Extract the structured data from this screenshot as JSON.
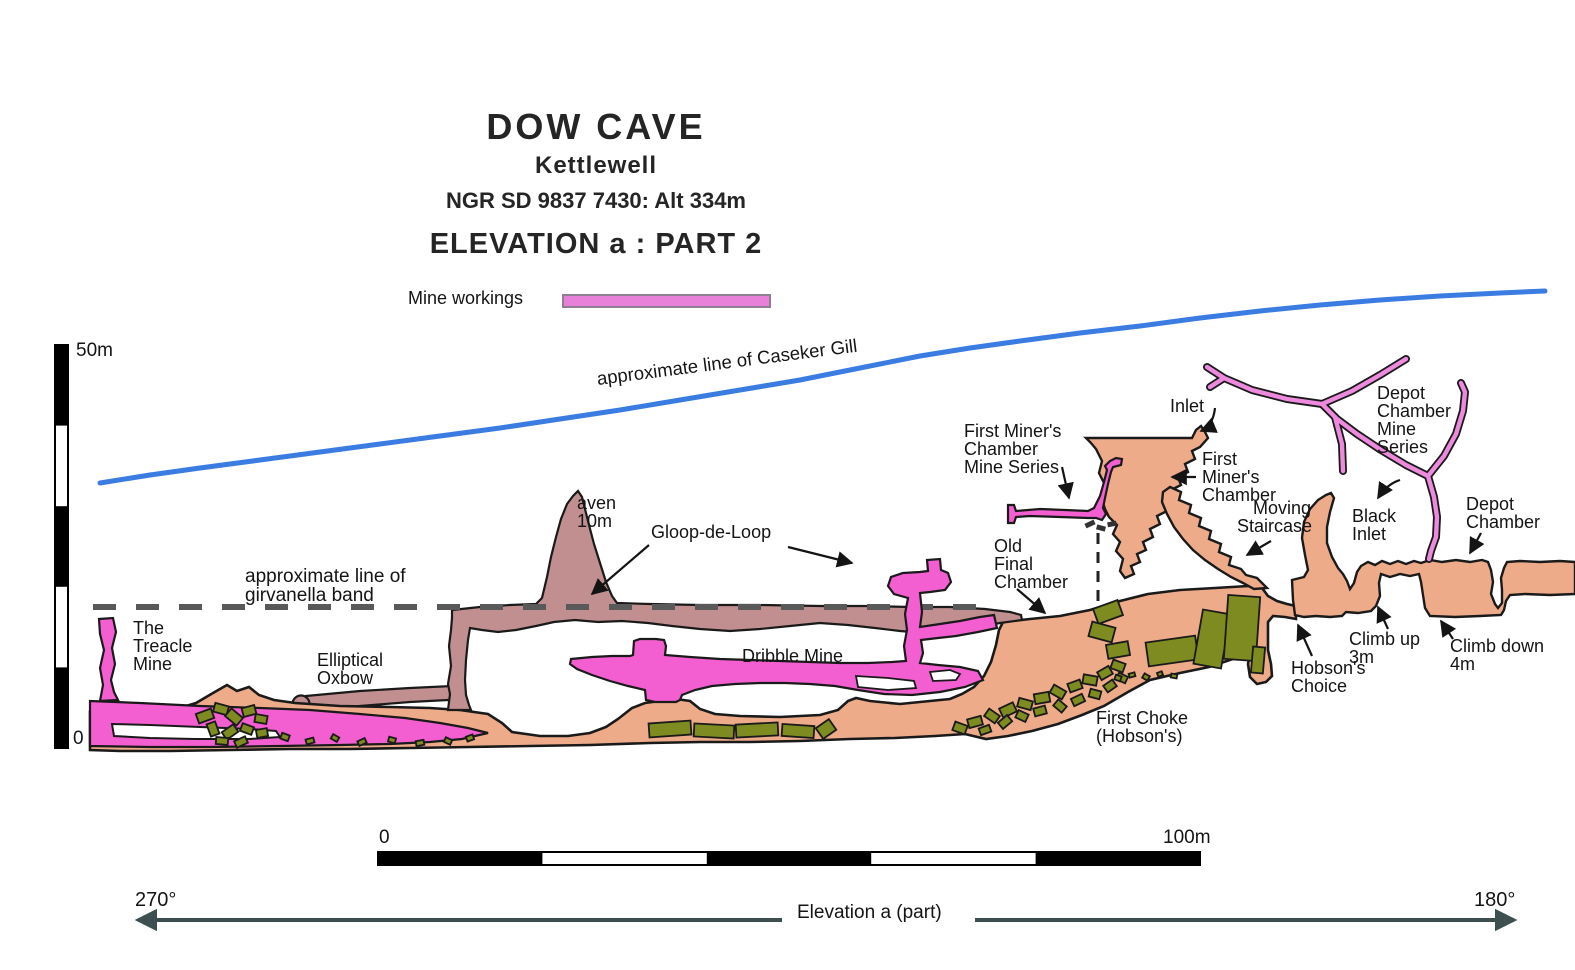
{
  "title_block": {
    "title": "DOW CAVE",
    "subtitle": "Kettlewell",
    "ngr": "NGR SD 9837 7430: Alt 334m",
    "heading": "ELEVATION a : PART 2"
  },
  "legend": {
    "mine_workings": "Mine workings"
  },
  "scale_vertical": {
    "top": "50m",
    "bottom": "0"
  },
  "scale_horizontal": {
    "left": "0",
    "right": "100m"
  },
  "surface_line": {
    "label": "approximate line of Caseker Gill"
  },
  "girvanella": {
    "line1": "approximate line of",
    "line2": "girvanella band"
  },
  "map_labels": {
    "aven": {
      "line1": "aven",
      "line2": "10m"
    },
    "gloop": "Gloop-de-Loop",
    "treacle": {
      "line1": "The",
      "line2": "Treacle",
      "line3": "Mine"
    },
    "oxbow": {
      "line1": "Elliptical",
      "line2": "Oxbow"
    },
    "dribble": "Dribble Mine",
    "old_final": {
      "line1": "Old",
      "line2": "Final",
      "line3": "Chamber"
    },
    "fmc_series": {
      "line1": "First Miner's",
      "line2": "Chamber",
      "line3": "Mine Series"
    },
    "inlet": "Inlet",
    "fmc": {
      "line1": "First",
      "line2": "Miner's",
      "line3": "Chamber"
    },
    "moving": {
      "line1": "Moving",
      "line2": "Staircase"
    },
    "black_inlet": {
      "line1": "Black",
      "line2": "Inlet"
    },
    "depot_series": {
      "line1": "Depot",
      "line2": "Chamber",
      "line3": "Mine",
      "line4": "Series"
    },
    "depot_chamber": {
      "line1": "Depot",
      "line2": "Chamber"
    },
    "climb_up": {
      "line1": "Climb up",
      "line2": "3m"
    },
    "climb_down": {
      "line1": "Climb down",
      "line2": "4m"
    },
    "hobsons": {
      "line1": "Hobson's",
      "line2": "Choice"
    },
    "first_choke": {
      "line1": "First Choke",
      "line2": "(Hobson's)"
    }
  },
  "footer": {
    "bearing_left": "270°",
    "bearing_right": "180°",
    "caption": "Elevation a (part)"
  },
  "colors": {
    "mine_pink": "#f35fd1",
    "legend_pink": "#e87fd8",
    "passage_tan": "#eeab8a",
    "shading_mauve": "#c18f90",
    "boulder_olive": "#7d8b21",
    "gill_blue": "#3b7ce2",
    "band_grey": "#595959",
    "arrow_slate": "#3e4f4f"
  }
}
